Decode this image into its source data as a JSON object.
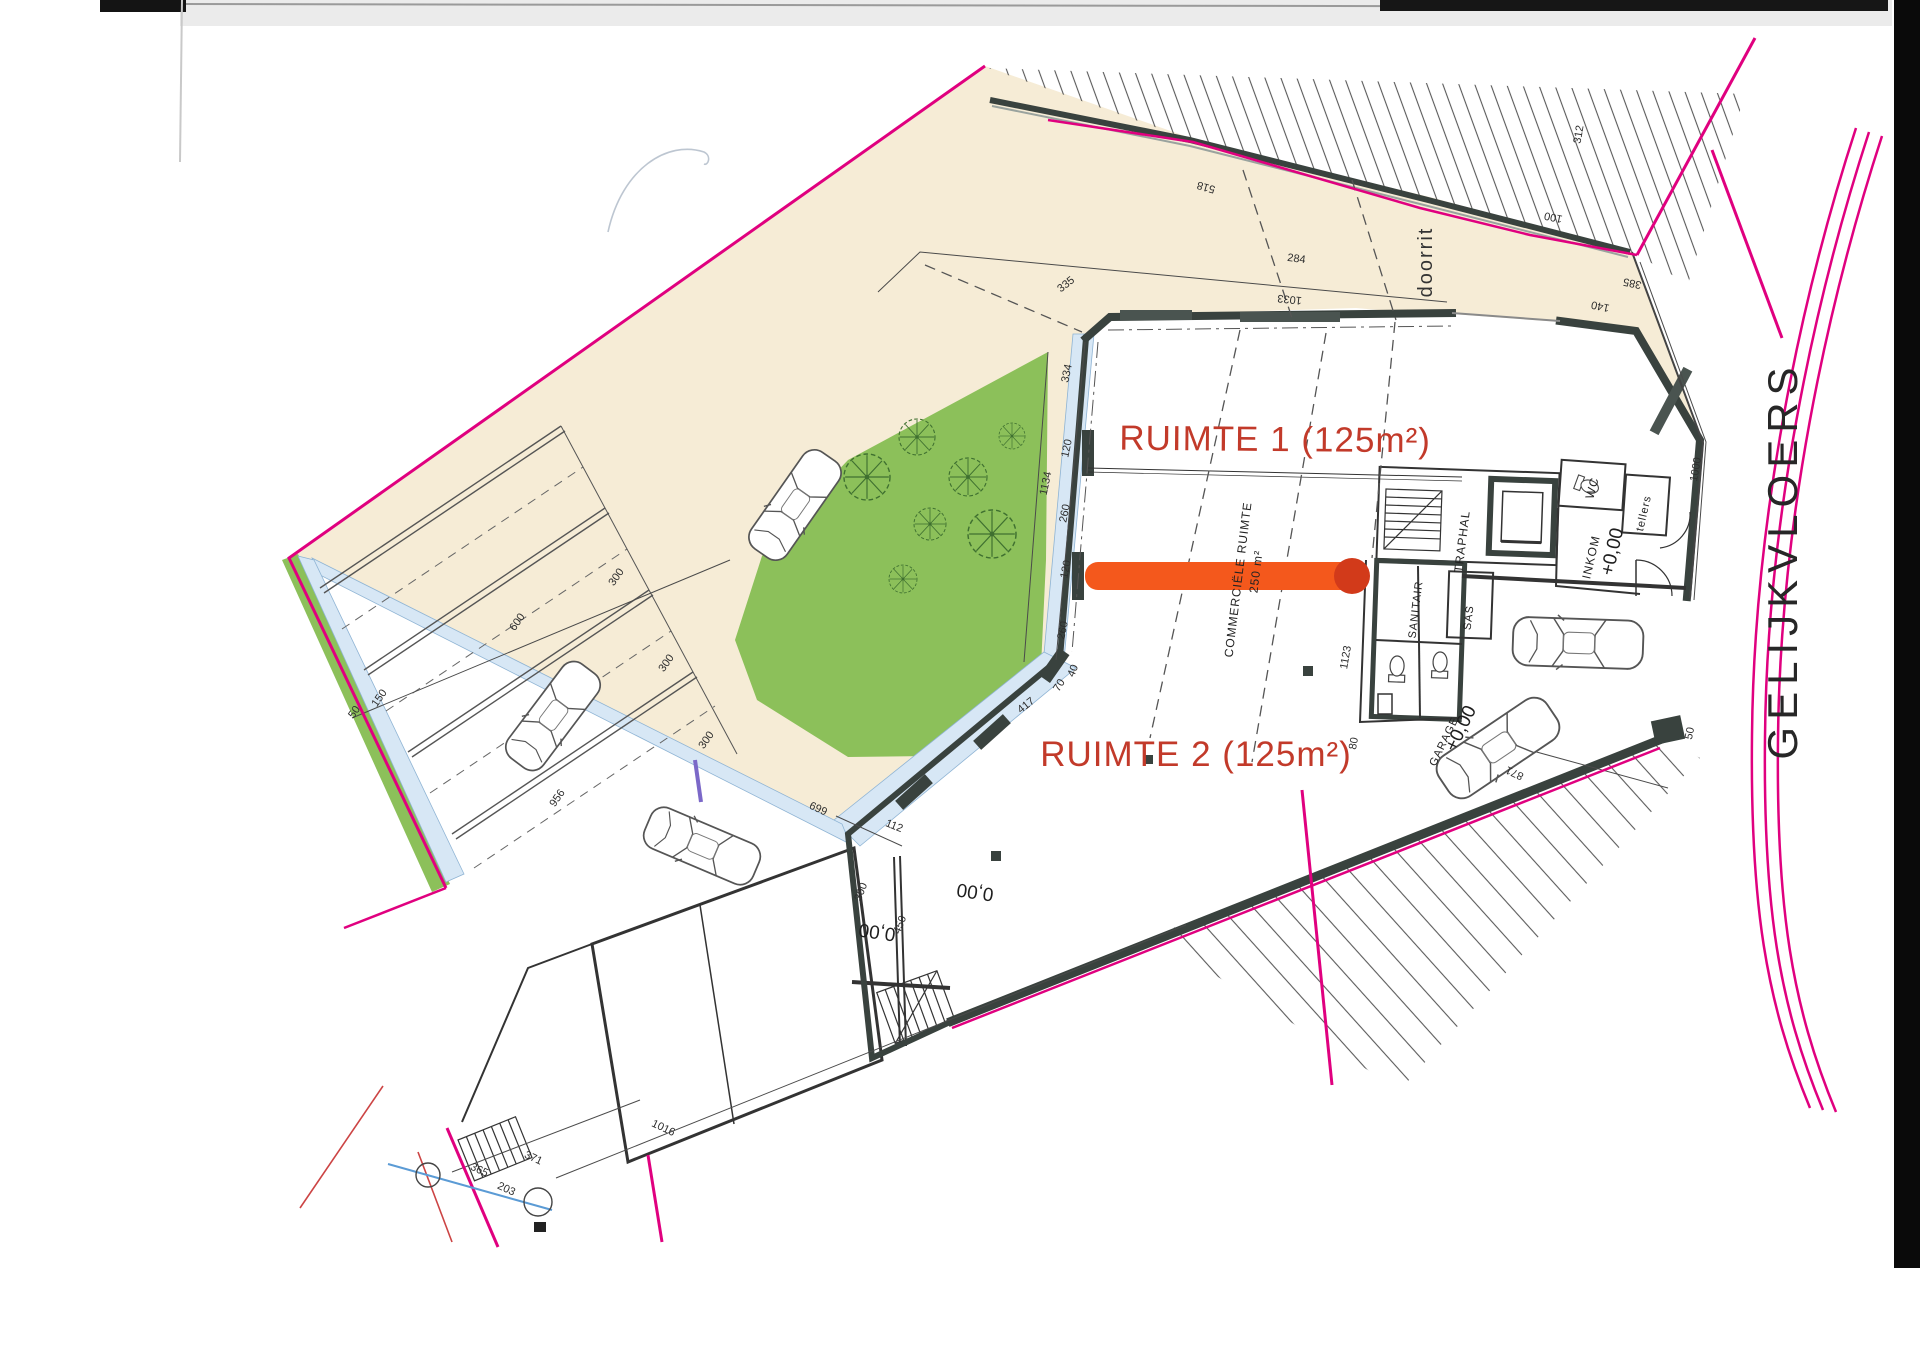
{
  "plan": {
    "title": "GELIJKVLOERS",
    "labels": {
      "ruimte1": "RUIMTE 1 (125m²)",
      "ruimte2": "RUIMTE 2 (125m²)",
      "doorrit": "doorrit",
      "commercial": "COMMERCIËLE RUIMTE",
      "commercial_area": "250 m²",
      "traphal": "TRAPHAL",
      "sanitair": "SANITAIR",
      "sas": "SAS",
      "wc": "WC",
      "inkom": "INKOM",
      "inkom_level": "+0,00",
      "tellers": "tellers",
      "garage": "GARAGE",
      "garage_level": "+0,00",
      "level_a": "0,00",
      "level_b": "0,00"
    },
    "colors": {
      "boundary_magenta": "#e0007f",
      "grass_green": "#8cc05a",
      "pavement_beige": "#f6ecd6",
      "walkway_blue": "#d7e7f5",
      "highlight_orange": "#f4581c",
      "highlight_end_red": "#d23a1a",
      "label_red": "#c23a2a",
      "wall_dark": "#39423e",
      "aux_blue_line": "#5b9bd5",
      "aux_red_line": "#cc4444"
    },
    "dimensions": [
      {
        "v": "335",
        "x": 1068,
        "y": 287,
        "r": -38
      },
      {
        "v": "1033",
        "x": 1290,
        "y": 296,
        "r": 186
      },
      {
        "v": "518",
        "x": 1207,
        "y": 184,
        "r": 196
      },
      {
        "v": "100",
        "x": 1554,
        "y": 214,
        "r": 192
      },
      {
        "v": "385",
        "x": 1633,
        "y": 280,
        "r": 192
      },
      {
        "v": "140",
        "x": 1601,
        "y": 303,
        "r": 192
      },
      {
        "v": "312",
        "x": 1582,
        "y": 135,
        "r": -80
      },
      {
        "v": "284",
        "x": 1296,
        "y": 262,
        "r": 8
      },
      {
        "v": "334",
        "x": 1070,
        "y": 374,
        "r": -78
      },
      {
        "v": "120",
        "x": 1070,
        "y": 449,
        "r": -78
      },
      {
        "v": "260",
        "x": 1068,
        "y": 514,
        "r": -78
      },
      {
        "v": "120",
        "x": 1069,
        "y": 570,
        "r": -78
      },
      {
        "v": "260",
        "x": 1066,
        "y": 631,
        "r": -78
      },
      {
        "v": "40",
        "x": 1076,
        "y": 672,
        "r": -68
      },
      {
        "v": "70",
        "x": 1062,
        "y": 687,
        "r": -58
      },
      {
        "v": "417",
        "x": 1028,
        "y": 708,
        "r": -38
      },
      {
        "v": "1134",
        "x": 1049,
        "y": 484,
        "r": -78
      },
      {
        "v": "112",
        "x": 893,
        "y": 829,
        "r": 22
      },
      {
        "v": "300",
        "x": 864,
        "y": 893,
        "r": -68
      },
      {
        "v": "450",
        "x": 903,
        "y": 926,
        "r": -68
      },
      {
        "v": "600",
        "x": 520,
        "y": 624,
        "r": -55
      },
      {
        "v": "300",
        "x": 619,
        "y": 579,
        "r": -55
      },
      {
        "v": "300",
        "x": 669,
        "y": 665,
        "r": -55
      },
      {
        "v": "300",
        "x": 709,
        "y": 742,
        "r": -55
      },
      {
        "v": "150",
        "x": 382,
        "y": 700,
        "r": -55
      },
      {
        "v": "50",
        "x": 357,
        "y": 714,
        "r": -55
      },
      {
        "v": "669",
        "x": 820,
        "y": 805,
        "r": 205
      },
      {
        "v": "956",
        "x": 560,
        "y": 800,
        "r": -55
      },
      {
        "v": "1016",
        "x": 662,
        "y": 1131,
        "r": 25
      },
      {
        "v": "371",
        "x": 532,
        "y": 1161,
        "r": 25
      },
      {
        "v": "203",
        "x": 505,
        "y": 1192,
        "r": 25
      },
      {
        "v": "365",
        "x": 478,
        "y": 1173,
        "r": 25
      },
      {
        "v": "871",
        "x": 1516,
        "y": 770,
        "r": 205
      },
      {
        "v": "50",
        "x": 1693,
        "y": 734,
        "r": -78
      },
      {
        "v": "1000",
        "x": 1699,
        "y": 470,
        "r": -80
      },
      {
        "v": "1123",
        "x": 1349,
        "y": 658,
        "r": -80
      },
      {
        "v": "80",
        "x": 1357,
        "y": 744,
        "r": -80
      }
    ]
  }
}
